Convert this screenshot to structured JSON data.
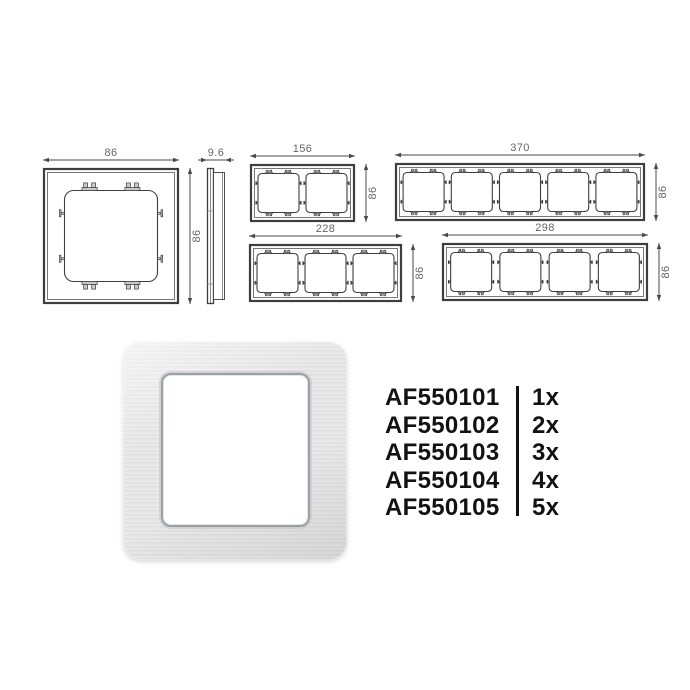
{
  "colors": {
    "line": "#3e3e3e",
    "tab_fill": "#c9c9c9",
    "dim_line": "#4a4a4a",
    "dim_text": "#666666",
    "text": "#121212"
  },
  "drawings": {
    "single_front": {
      "gangs": 1,
      "width_label": "86",
      "height_label": "86"
    },
    "side_profile": {
      "depth_label": "9.6"
    },
    "gang2": {
      "gangs": 2,
      "width_label": "156",
      "height_label": "86"
    },
    "gang5": {
      "gangs": 5,
      "width_label": "370",
      "height_label": "86"
    },
    "gang3": {
      "gangs": 3,
      "width_label": "228",
      "height_label": "86"
    },
    "gang4": {
      "gangs": 4,
      "width_label": "298",
      "height_label": "86"
    }
  },
  "parts": [
    {
      "sku": "AF550101",
      "qty": "1x"
    },
    {
      "sku": "AF550102",
      "qty": "2x"
    },
    {
      "sku": "AF550103",
      "qty": "3x"
    },
    {
      "sku": "AF550104",
      "qty": "4x"
    },
    {
      "sku": "AF550105",
      "qty": "5x"
    }
  ]
}
